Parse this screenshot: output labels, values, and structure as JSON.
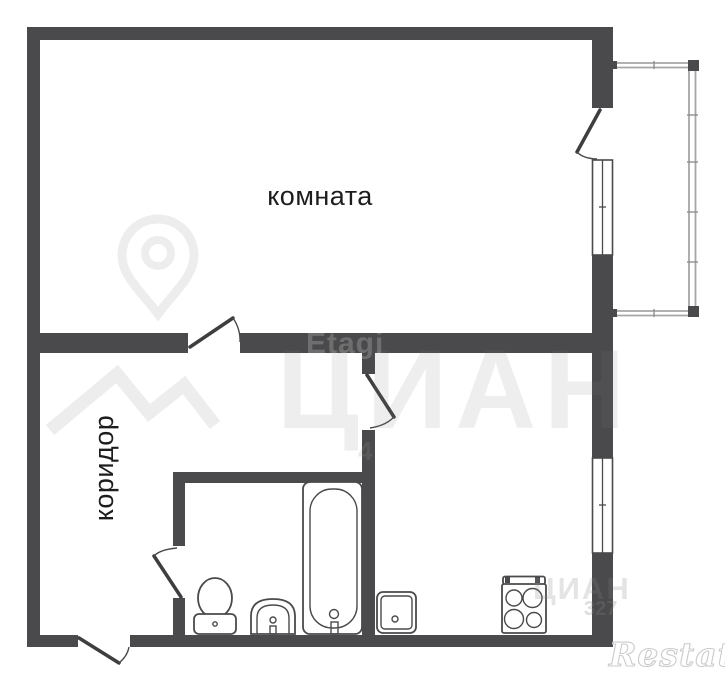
{
  "plan": {
    "labels": {
      "room": "комната",
      "corridor": "коридор"
    },
    "fixtures": [
      "toilet-icon",
      "bathroom-sink-icon",
      "bathtub-icon",
      "kitchen-sink-icon",
      "stove-icon"
    ],
    "features": [
      "balcony-railing",
      "room-window",
      "kitchen-window",
      "balcony-door",
      "room-door",
      "kitchen-door",
      "bathroom-door",
      "entrance-door"
    ]
  },
  "watermarks": {
    "etagi": "Etagi",
    "cian_large": "ЦИАН",
    "cian_small": "ЦИАН",
    "cian_digits": "327",
    "partial_digit": "4",
    "restate": "Restate",
    "pin_icon": "location-pin-icon"
  },
  "colors": {
    "background": "#ffffff",
    "wall": "#4a4a4c",
    "line": "#3e3e40",
    "balcony_rail": "#a6a6a6",
    "label_text": "#1d1d1d",
    "watermark_light": "#ececec"
  }
}
